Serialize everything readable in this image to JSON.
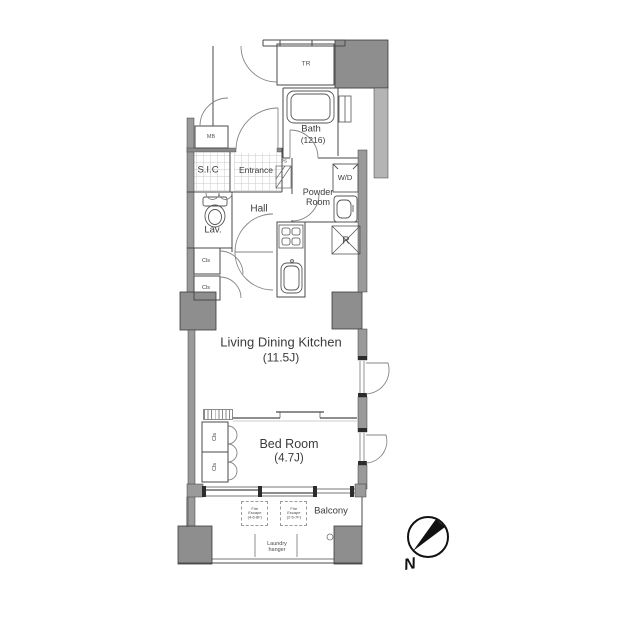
{
  "floorplan": {
    "rooms": {
      "tr": "TR",
      "mb": "MB",
      "sic": "S.I.C",
      "entrance": "Entrance",
      "ps": "PS",
      "bath": {
        "name": "Bath",
        "size": "(1216)"
      },
      "wd": "W/D",
      "powder_room": {
        "line1": "Powder",
        "line2": "Room"
      },
      "hall": "Hall",
      "lav": "Lav.",
      "fridge": "R",
      "closet": "Cls",
      "ldk": {
        "name": "Living Dining Kitchen",
        "size": "(11.5J)"
      },
      "bedroom": {
        "name": "Bed Room",
        "size": "(4.7J)"
      },
      "balcony": "Balcony"
    },
    "annotations": {
      "fire_escape_1": {
        "line1": "Fire",
        "line2": "Escape",
        "line3": "(4-6-8F)"
      },
      "fire_escape_2": {
        "line1": "Fire",
        "line2": "Escape",
        "line3": "(2-5-7F)"
      },
      "laundry": {
        "line1": "Laundry",
        "line2": "hanger"
      }
    },
    "compass": {
      "north": "N"
    },
    "colors": {
      "pillar": "#8e8e8e",
      "wall": "#9a9a9a",
      "light_band": "#b4b4b4",
      "line": "#4a4a4a",
      "background": "#ffffff"
    }
  }
}
